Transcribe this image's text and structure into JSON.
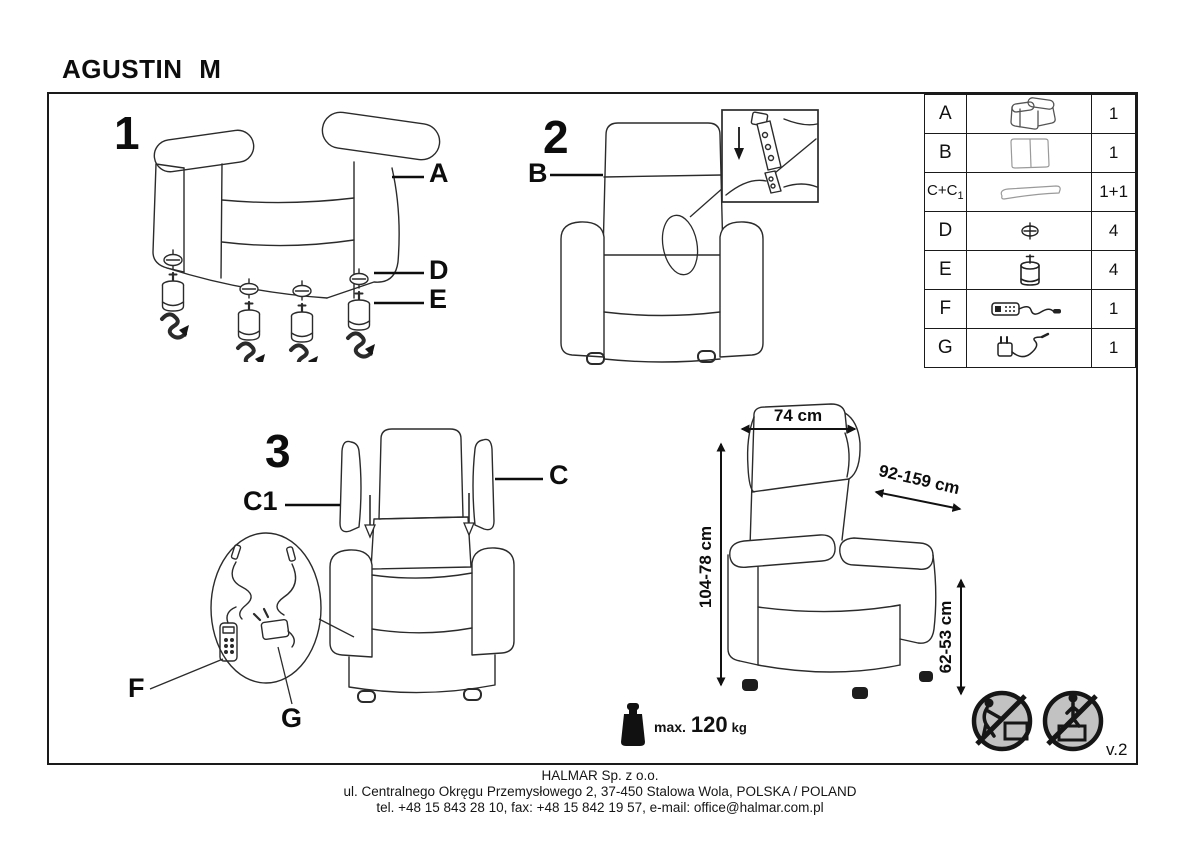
{
  "title": "AGUSTIN M",
  "steps": [
    "1",
    "2",
    "3"
  ],
  "callouts": {
    "a": "A",
    "b": "B",
    "c": "C",
    "c1": "C1",
    "d": "D",
    "e": "E",
    "f": "F",
    "g": "G"
  },
  "parts_table": {
    "rows": [
      {
        "letter": "A",
        "icon": "armchair-body-icon",
        "qty": "1"
      },
      {
        "letter": "B",
        "icon": "backrest-icon",
        "qty": "1"
      },
      {
        "letter": "C+C",
        "letter_sub": "1",
        "icon": "wing-cushion-icon",
        "qty": "1+1"
      },
      {
        "letter": "D",
        "icon": "screw-icon",
        "qty": "4"
      },
      {
        "letter": "E",
        "icon": "leg-icon",
        "qty": "4"
      },
      {
        "letter": "F",
        "icon": "remote-control-icon",
        "qty": "1"
      },
      {
        "letter": "G",
        "icon": "power-adapter-icon",
        "qty": "1"
      }
    ]
  },
  "dimensions": {
    "width": "74 cm",
    "depth": "92-159 cm",
    "height": "104-78 cm",
    "seat_height": "62-53 cm"
  },
  "weight_limit": {
    "label": "max.",
    "value": "120",
    "unit": "kg"
  },
  "version": "v.2",
  "footer": {
    "company": "HALMAR Sp. z o.o.",
    "address": "ul. Centralnego Okręgu Przemysłowego 2, 37-450 Stalowa Wola, POLSKA / POLAND",
    "contact": "tel. +48 15 843 28 10, fax: +48 15 842 19 57, e-mail: office@halmar.com.pl"
  }
}
